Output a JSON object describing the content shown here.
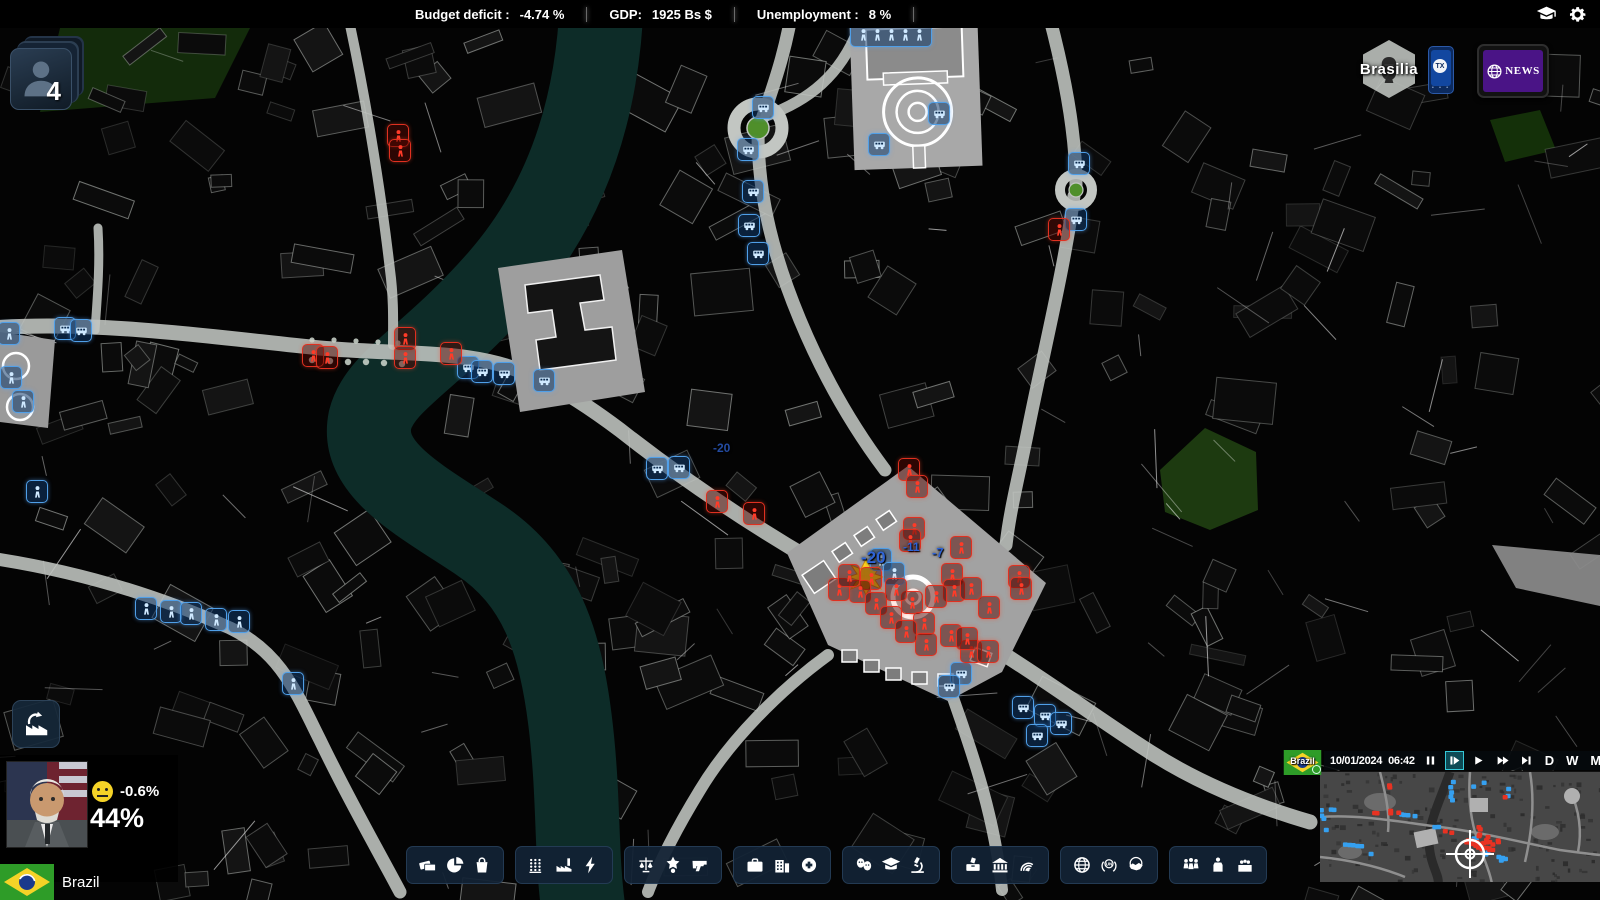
{
  "top_bar": {
    "stats": [
      {
        "label": "Budget deficit :",
        "value": "-4.74 %"
      },
      {
        "label": "GDP:",
        "value": "1925 Bs  $"
      },
      {
        "label": "Unemployment :",
        "value": "8 %"
      }
    ]
  },
  "top_right": {
    "icons": [
      "tutorial-icon",
      "settings-icon"
    ]
  },
  "alerts": {
    "count": "4"
  },
  "region": {
    "name": "Brasilia"
  },
  "phone": {
    "label": "TX"
  },
  "news": {
    "label": "NEWS"
  },
  "player": {
    "mood": "-0.6%",
    "approval": "44%",
    "country": "Brazil"
  },
  "toolbar": {
    "groups": [
      {
        "name": "finance",
        "icons": [
          "cash",
          "pie-chart",
          "shopping-bag"
        ]
      },
      {
        "name": "economy",
        "icons": [
          "wheat",
          "factory",
          "bolt"
        ]
      },
      {
        "name": "law-order",
        "icons": [
          "scales",
          "star-badge",
          "pistol"
        ]
      },
      {
        "name": "social-health",
        "icons": [
          "briefcase",
          "hospital",
          "health-plus"
        ]
      },
      {
        "name": "culture-education",
        "icons": [
          "masks",
          "grad-cap",
          "microscope"
        ]
      },
      {
        "name": "state-institutions",
        "icons": [
          "ballot-box",
          "bank",
          "radio-waves"
        ]
      },
      {
        "name": "foreign-affairs",
        "icons": [
          "globe",
          "un-globe",
          "handshake"
        ]
      },
      {
        "name": "politics-society",
        "icons": [
          "crowd",
          "podium",
          "parliament"
        ]
      }
    ]
  },
  "time_panel": {
    "date": "10/01/2024",
    "time": "06:42",
    "controls": [
      "pause",
      "step",
      "play",
      "fast-forward",
      "skip-forward"
    ],
    "active_control": "step",
    "speeds": [
      "D",
      "W",
      "M"
    ],
    "flag_label": "Brazil"
  },
  "map": {
    "city": "Brasilia",
    "numbers": [
      {
        "text": "-20",
        "x": 713,
        "y": 441,
        "size": 12,
        "dim": true
      },
      {
        "text": "-20",
        "x": 861,
        "y": 548,
        "size": 17,
        "dim": false
      },
      {
        "text": "-11",
        "x": 903,
        "y": 540,
        "size": 12,
        "dim": false
      },
      {
        "text": "-7",
        "x": 932,
        "y": 545,
        "size": 13,
        "dim": false
      }
    ],
    "markers": {
      "blue_vehicles": [
        [
          762,
          106
        ],
        [
          747,
          148
        ],
        [
          752,
          190
        ],
        [
          748,
          224
        ],
        [
          757,
          252
        ],
        [
          878,
          143
        ],
        [
          938,
          112
        ],
        [
          1078,
          162
        ],
        [
          1075,
          218
        ],
        [
          656,
          467
        ],
        [
          678,
          466
        ],
        [
          467,
          366
        ],
        [
          481,
          370
        ],
        [
          503,
          372
        ],
        [
          543,
          379
        ],
        [
          64,
          327
        ],
        [
          80,
          329
        ],
        [
          1022,
          706
        ],
        [
          1044,
          714
        ],
        [
          1060,
          722
        ],
        [
          1036,
          734
        ],
        [
          960,
          672
        ],
        [
          948,
          685
        ]
      ],
      "blue_people": [
        [
          145,
          607
        ],
        [
          170,
          610
        ],
        [
          190,
          612
        ],
        [
          215,
          618
        ],
        [
          238,
          620
        ],
        [
          36,
          490
        ],
        [
          292,
          682
        ],
        [
          8,
          332
        ],
        [
          10,
          376
        ],
        [
          22,
          400
        ],
        [
          880,
          558
        ],
        [
          893,
          572
        ]
      ],
      "red_people": [
        [
          312,
          354
        ],
        [
          326,
          356
        ],
        [
          404,
          337
        ],
        [
          404,
          356
        ],
        [
          450,
          352
        ],
        [
          397,
          134
        ],
        [
          399,
          149
        ],
        [
          1058,
          228
        ],
        [
          908,
          468
        ],
        [
          916,
          485
        ],
        [
          716,
          500
        ],
        [
          753,
          512
        ],
        [
          913,
          527
        ],
        [
          909,
          539
        ],
        [
          960,
          546
        ],
        [
          870,
          577
        ],
        [
          859,
          590
        ],
        [
          875,
          602
        ],
        [
          890,
          616
        ],
        [
          911,
          601
        ],
        [
          923,
          622
        ],
        [
          951,
          573
        ],
        [
          953,
          589
        ],
        [
          970,
          587
        ],
        [
          988,
          606
        ],
        [
          1018,
          575
        ],
        [
          1020,
          587
        ],
        [
          925,
          643
        ],
        [
          970,
          650
        ],
        [
          987,
          650
        ],
        [
          838,
          588
        ],
        [
          848,
          574
        ],
        [
          895,
          588
        ],
        [
          935,
          595
        ],
        [
          905,
          630
        ],
        [
          950,
          634
        ],
        [
          966,
          637
        ]
      ],
      "crowd": [
        [
          890,
          33
        ]
      ],
      "explosion": [
        [
          866,
          577
        ]
      ]
    }
  },
  "colors": {
    "accent_blue": "#4f9fe8",
    "alert_red": "#e03020",
    "panel_navy": "#16283a",
    "news_purple": "#4a1486",
    "flag_green": "#2e9c28",
    "teal_highlight": "#35c8d8",
    "number_blue": "#2e63d6"
  }
}
